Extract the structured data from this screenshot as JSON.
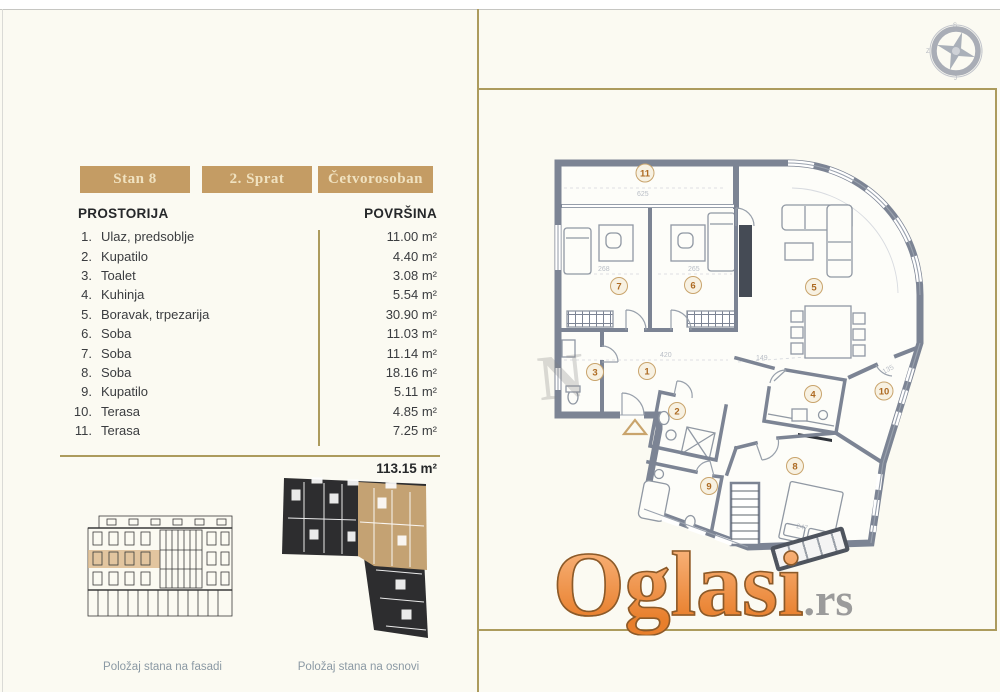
{
  "badges": [
    {
      "label": "Stan 8"
    },
    {
      "label": "2. Sprat"
    },
    {
      "label": "Četvorosoban"
    }
  ],
  "table": {
    "header_room": "PROSTORIJA",
    "header_area": "POVRŠINA",
    "rows": [
      {
        "num": "1.",
        "name": "Ulaz, predsoblje",
        "area": "11.00 m²"
      },
      {
        "num": "2.",
        "name": "Kupatilo",
        "area": "4.40 m²"
      },
      {
        "num": "3.",
        "name": "Toalet",
        "area": "3.08 m²"
      },
      {
        "num": "4.",
        "name": "Kuhinja",
        "area": "5.54 m²"
      },
      {
        "num": "5.",
        "name": "Boravak, trpezarija",
        "area": "30.90 m²"
      },
      {
        "num": "6.",
        "name": "Soba",
        "area": "11.03 m²"
      },
      {
        "num": "7.",
        "name": "Soba",
        "area": "11.14 m²"
      },
      {
        "num": "8.",
        "name": "Soba",
        "area": "18.16 m²"
      },
      {
        "num": "9.",
        "name": "Kupatilo",
        "area": "5.11 m²"
      },
      {
        "num": "10.",
        "name": "Terasa",
        "area": "4.85 m²"
      },
      {
        "num": "11.",
        "name": "Terasa",
        "area": "7.25 m²"
      }
    ],
    "total": "113.15 m²"
  },
  "captions": {
    "facade": "Položaj stana na fasadi",
    "plan": "Položaj stana na osnovi"
  },
  "floorplan": {
    "rooms": [
      "1",
      "2",
      "3",
      "4",
      "5",
      "6",
      "7",
      "8",
      "9",
      "10",
      "11"
    ],
    "dims": [
      "625",
      "268",
      "265",
      "420",
      "149",
      "247",
      "135"
    ]
  },
  "watermark": {
    "brand": "Oglasi",
    "tld": ".rs",
    "faint_letter": "N"
  },
  "compass": {
    "n": "S",
    "e": "I",
    "s": "J",
    "w": "Z"
  },
  "colors": {
    "accent_gold": "#ac9b5d",
    "badge_bg": "#c49c64",
    "wall_gray": "#7c8494",
    "brand_orange": "#ef8c3f",
    "highlight_tan": "#d9b385"
  }
}
